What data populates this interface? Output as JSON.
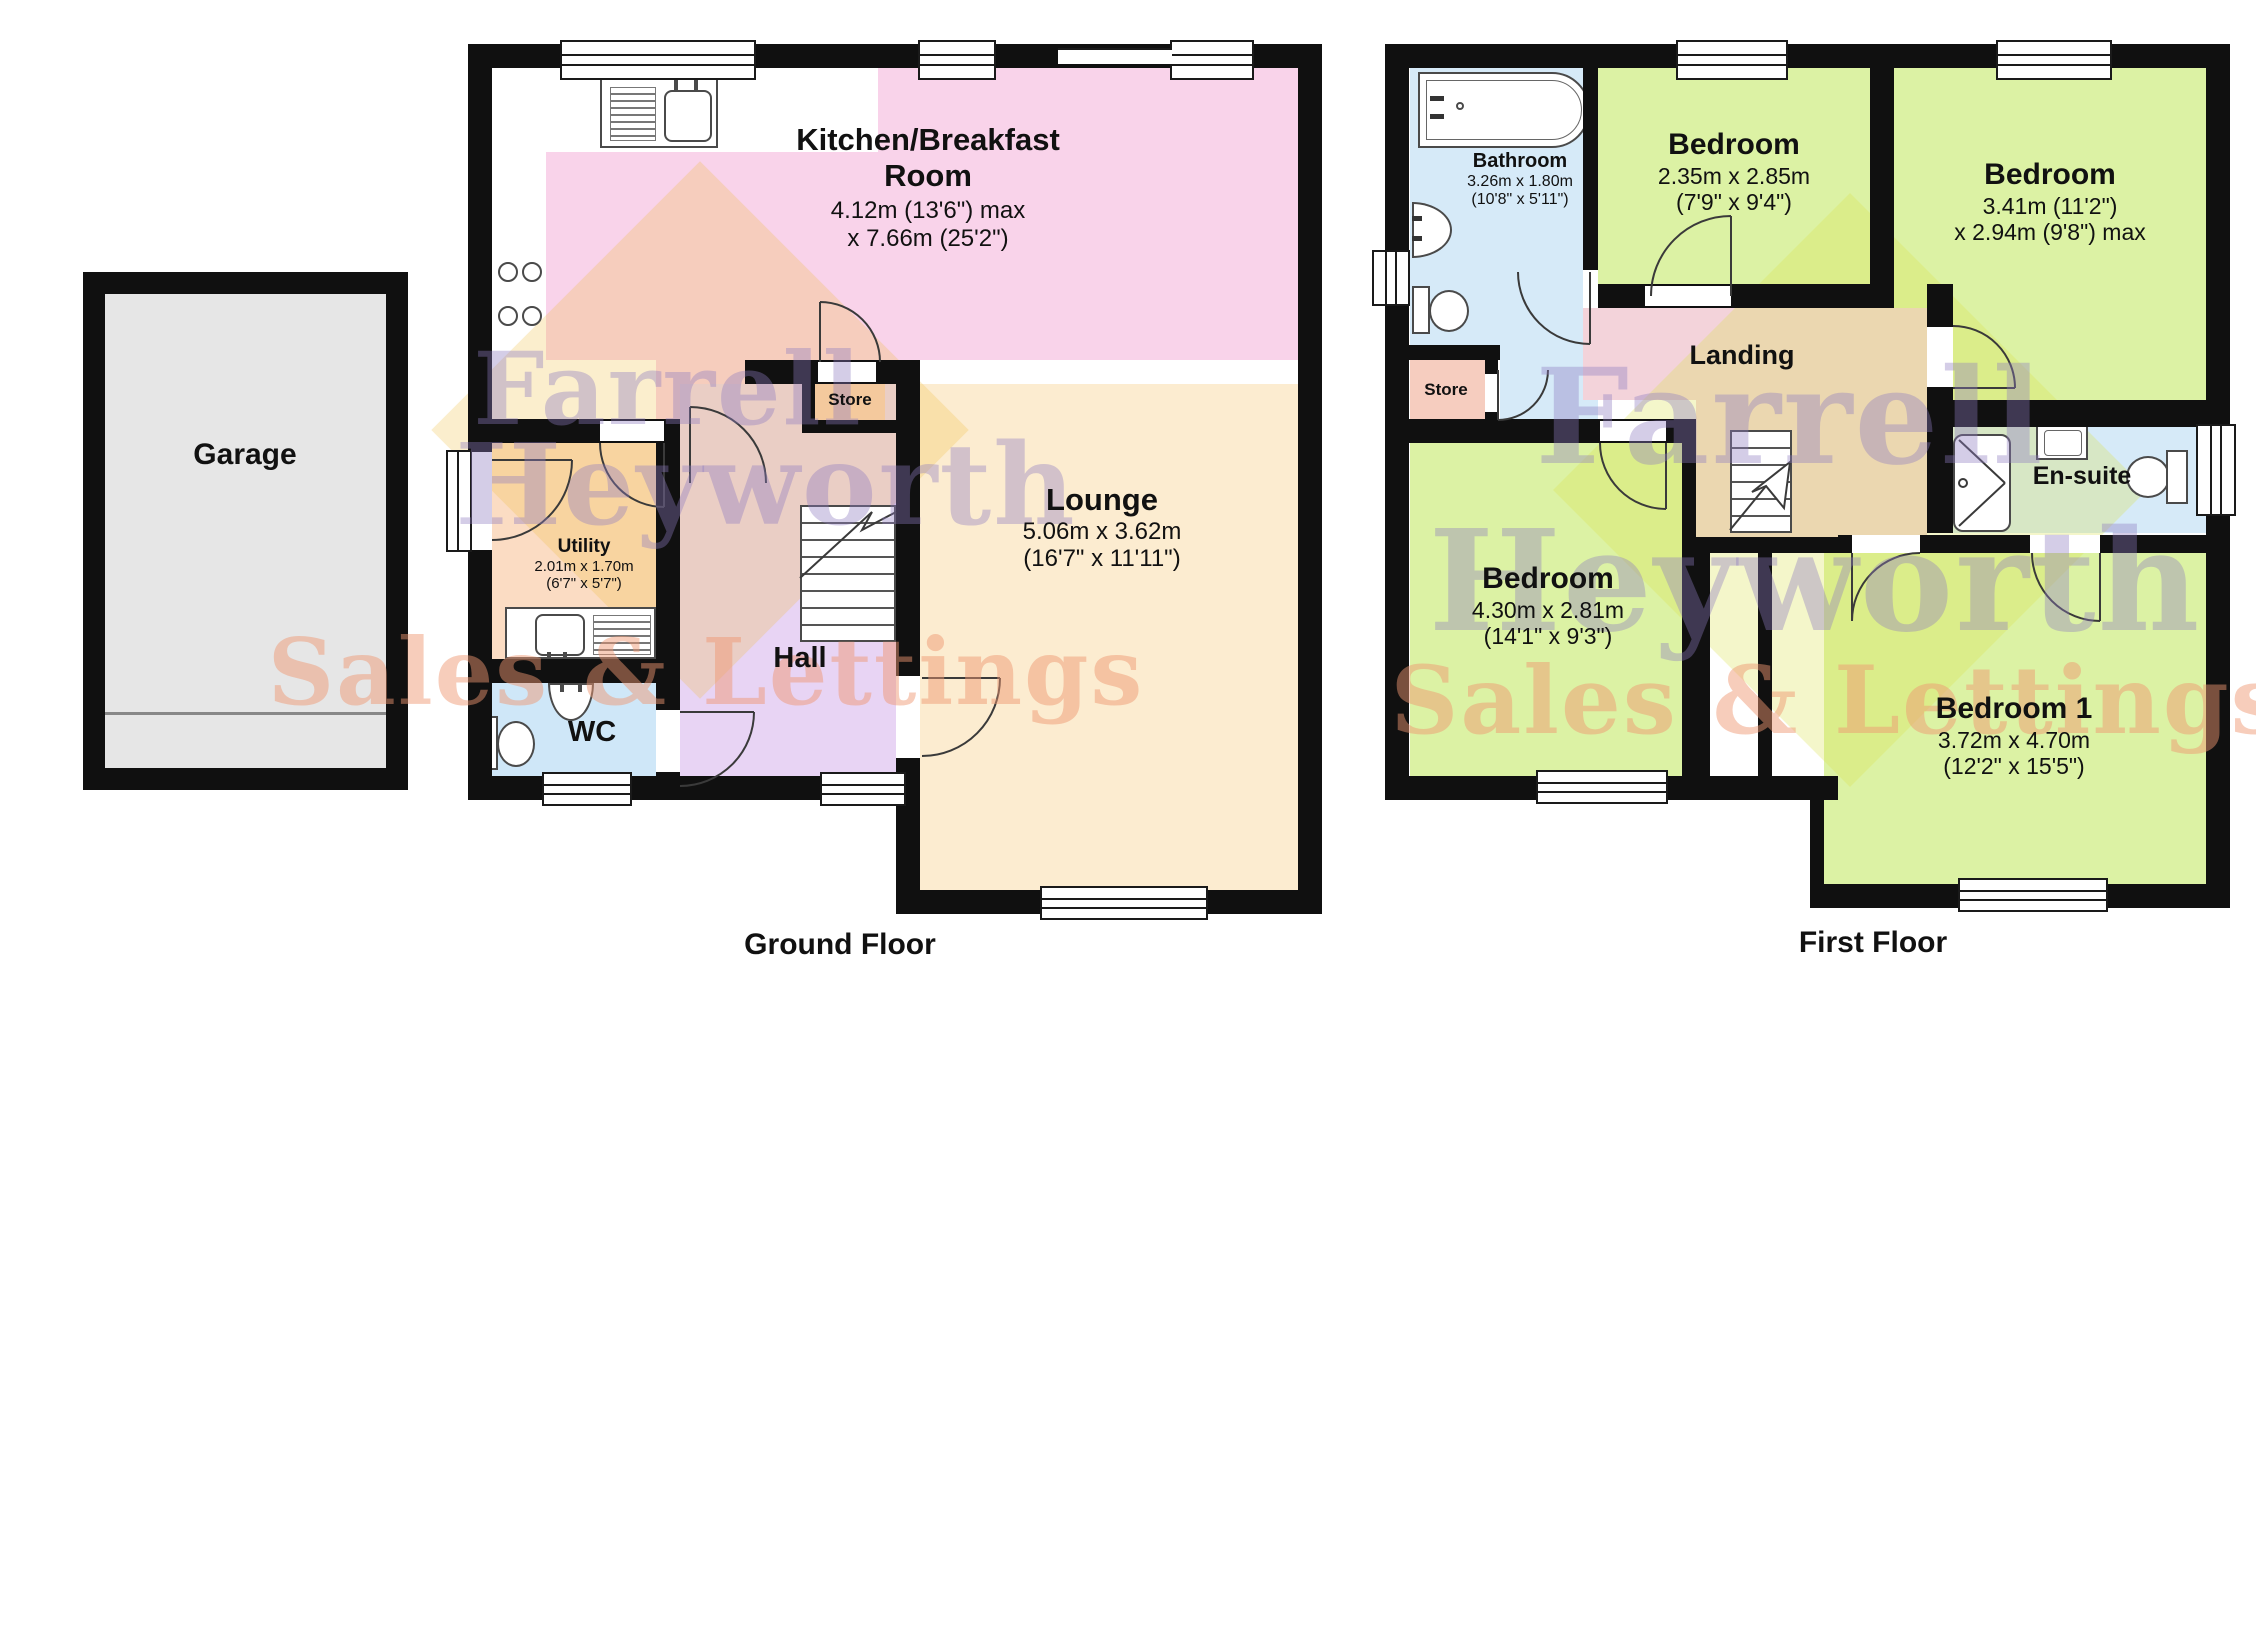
{
  "captions": {
    "ground": "Ground Floor",
    "first": "First Floor"
  },
  "watermark": {
    "line1": "Farrell",
    "line2": "Heyworth",
    "line3": "Sales & Lettings"
  },
  "colors": {
    "wall": "#101010",
    "kitchen": "#f9d3ea",
    "lounge": "#fcecd0",
    "hall": "#e8d4f4",
    "utility": "#fbdcc3",
    "wc": "#cfe7f8",
    "store": "#f6cdbf",
    "bedroom": "#dcf2a4",
    "landing": "#f3d3da",
    "bathroom": "#d6eaf8",
    "garage": "#e6e6e6",
    "watermark_purple": "#8f7cc0",
    "watermark_orange": "#ee9670",
    "logo_diamond": "#f0be3c"
  },
  "ground": {
    "garage": {
      "name": "Garage"
    },
    "kitchen": {
      "line1": "Kitchen/Breakfast",
      "line2": "Room",
      "dim1": "4.12m (13'6\") max",
      "dim2": "x 7.66m (25'2\")"
    },
    "lounge": {
      "name": "Lounge",
      "dim1": "5.06m x 3.62m",
      "dim2": "(16'7\" x 11'11\")"
    },
    "utility": {
      "name": "Utility",
      "dim1": "2.01m x 1.70m",
      "dim2": "(6'7\" x 5'7\")"
    },
    "wc": {
      "name": "WC"
    },
    "hall": {
      "name": "Hall"
    },
    "store": {
      "name": "Store"
    }
  },
  "first": {
    "bathroom": {
      "name": "Bathroom",
      "dim1": "3.26m x 1.80m",
      "dim2": "(10'8\" x 5'11\")"
    },
    "bedroom2": {
      "name": "Bedroom",
      "dim1": "2.35m x 2.85m",
      "dim2": "(7'9\" x 9'4\")"
    },
    "bedroom3": {
      "name": "Bedroom",
      "dim1": "3.41m (11'2\")",
      "dim2": "x 2.94m (9'8\") max"
    },
    "bedroom4": {
      "name": "Bedroom",
      "dim1": "4.30m x 2.81m",
      "dim2": "(14'1\" x 9'3\")"
    },
    "bedroom1": {
      "name": "Bedroom 1",
      "dim1": "3.72m x 4.70m",
      "dim2": "(12'2\" x 15'5\")"
    },
    "landing": {
      "name": "Landing"
    },
    "store": {
      "name": "Store"
    },
    "ensuite": {
      "name": "En-suite"
    }
  }
}
